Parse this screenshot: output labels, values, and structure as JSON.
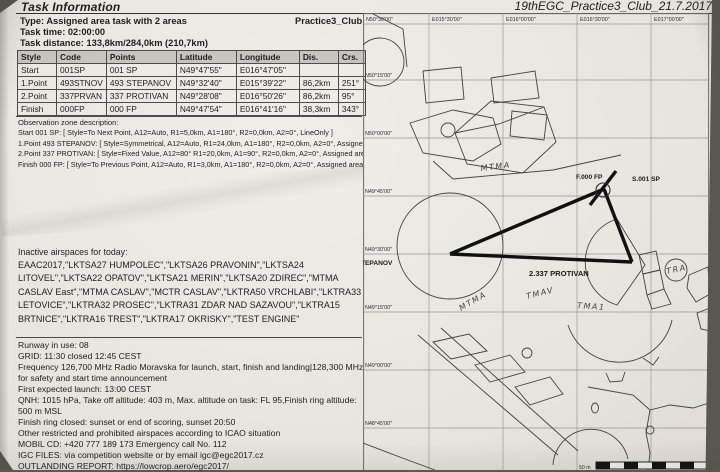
{
  "header": {
    "title": "Task Information",
    "doc_ref": "19thEGC_Practice3_Club_21.7.2017"
  },
  "task": {
    "type": "Type: Assigned area task with 2 areas",
    "club": "Practice3_Club",
    "time": "Task time: 02:00:00",
    "distance": "Task distance: 133,8km/284,0km (210,7km)"
  },
  "table": {
    "headers": [
      "Style",
      "Code",
      "Points",
      "Latitude",
      "Longitude",
      "Dis.",
      "Crs."
    ],
    "rows": [
      [
        "Start",
        "001SP",
        "001 SP",
        "N49°47'55\"",
        "E016°47'05\"",
        "",
        ""
      ],
      [
        "1.Point",
        "493STNOV",
        "493 STEPANOV",
        "N49°32'40\"",
        "E015°39'22\"",
        "86,2km",
        "251°"
      ],
      [
        "2.Point",
        "337PRVAN",
        "337 PROTIVAN",
        "N49°28'08\"",
        "E016°50'26\"",
        "86,2km",
        "95°"
      ],
      [
        "Finish",
        "000FP",
        "000 FP",
        "N49°47'54\"",
        "E016°41'16\"",
        "38,3km",
        "343°"
      ]
    ]
  },
  "observation": {
    "heading": "Observation zone description:",
    "lines": [
      "Start 001 SP: [ Style=To Next Point, A12=Auto, R1=5,0km, A1=180°, R2=0,0km, A2=0°, LineOnly ]",
      "1.Point 493 STEPANOV: [ Style=Symmetrical, A12=Auto, R1=24,0km, A1=180°, R2=0,0km, A2=0°, Assigned a",
      "2.Point 337 PROTIVAN: [ Style=Fixed Value, A12=80° R1=20,0km, A1=90°, R2=0,0km, A2=0°, Assigned area",
      "Finish 000 FP: [ Style=To Previous Point, A12=Auto, R1=3,0km, A1=180°, R2=0,0km, A2=0°, Assigned area ]"
    ]
  },
  "airspaces": {
    "heading": "Inactive airspaces for today:",
    "text": "EAAC2017,\"LKTSA27 HUMPOLEC\",\"LKTSA26 PRAVONIN\",\"LKTSA24 LITOVEL\",\"LKTSA22 OPATOV\",\"LKTSA21 MERIN\",\"LKTSA20 ZDIREC\",\"MTMA CASLAV East\",\"MTMA CASLAV\",\"MCTR CASLAV\",\"LKTRA50 VRCHLABI\",\"LKTRA33 LETOVICE\",\"LKTRA32 PROSEC\",\"LKTRA31 ZDAR NAD SAZAVOU\",\"LKTRA15 BRTNICE\",\"LKTRA16 TREST\",\"LKTRA17 OKRISKY\",\"TEST ENGINE\""
  },
  "briefing": {
    "lines": [
      "Runway in use: 08",
      "GRID: 11:30 closed 12:45 CEST",
      "Frequency 126,700 MHz Radio Moravska for launch, start, finish and landing|128,300 MHz for safety and start time announcement",
      "First expected launch: 13:00 CEST",
      "QNH: 1015 hPa, Take off altitude: 403 m, Max. altitude on task: FL 95,Finish ring altitude: 500 m MSL",
      "Finish ring closed: sunset or end of scoring, sunset 20:50",
      "Other restricted and prohibited airspaces according to ICAO situation",
      "MOBIL CD: +420 777 189 173 Emergency call No. 112",
      "IGC FILES: via competition website or by email igc@egc2017.cz",
      "OUTLANDING REPORT: https://lowcrop.aero/egc2017/"
    ]
  },
  "map": {
    "top_labels": [
      "N50°30'00\"",
      "E015°30'00\"",
      "E016°00'00\"",
      "E016°30'00\"",
      "E017°00'00\""
    ],
    "lat_labels": [
      "N50°15'00\"",
      "N50°00'00\"",
      "N49°45'00\"",
      "N49°30'00\"",
      "N49°15'00\"",
      "N49°00'00\"",
      "N48°45'00\""
    ],
    "labels": {
      "finish": "F.000 FP",
      "start": "S.001 SP",
      "protivan": "2.337 PROTIVAN",
      "stepanov_partial": "TEPANOV"
    },
    "handwritten": [
      "MTMA",
      "MTMA",
      "TMAV",
      "TMA1",
      "TRA"
    ],
    "scale_label": "50 m"
  }
}
